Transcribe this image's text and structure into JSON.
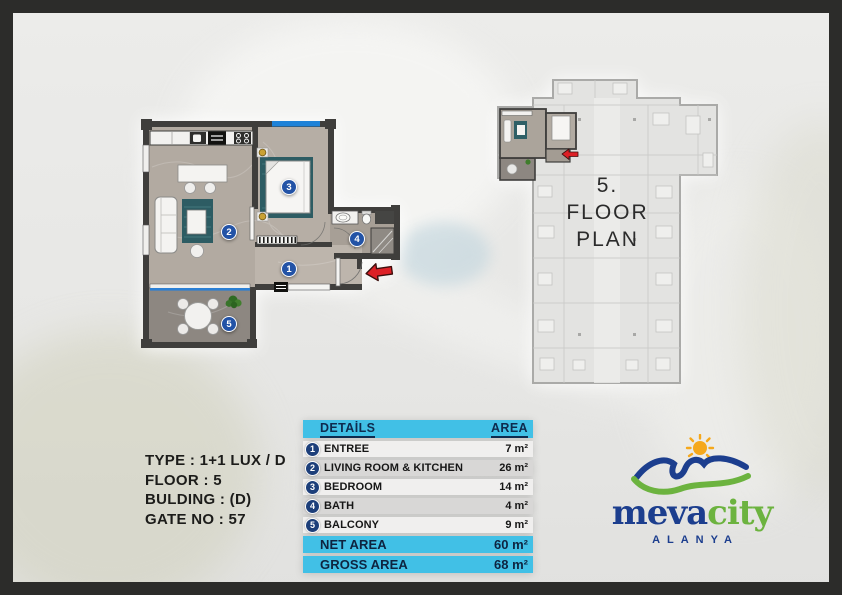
{
  "info": {
    "lines": [
      "TYPE : 1+1 LUX / D",
      "FLOOR : 5",
      "BULDING : (D)",
      "GATE NO : 57"
    ]
  },
  "floor_plan": {
    "line1": "5.",
    "line2": "FLOOR",
    "line3": "PLAN"
  },
  "table": {
    "header": {
      "details": "DETAİLS",
      "area": "AREA"
    },
    "rows": [
      {
        "num": "1",
        "label": "ENTREE",
        "area": "7 m²"
      },
      {
        "num": "2",
        "label": "LIVING ROOM & KITCHEN",
        "area": "26 m²"
      },
      {
        "num": "3",
        "label": "BEDROOM",
        "area": "14 m²"
      },
      {
        "num": "4",
        "label": "BATH",
        "area": "4 m²"
      },
      {
        "num": "5",
        "label": "BALCONY",
        "area": "9 m²"
      }
    ],
    "totals": [
      {
        "label": "NET AREA",
        "area": "60 m²"
      },
      {
        "label": "GROSS AREA",
        "area": "68 m²"
      }
    ]
  },
  "logo": {
    "brand_part1": "meva",
    "brand_part2": "city",
    "city": "ALANYA"
  },
  "colors": {
    "accent_cyan": "#41c0e6",
    "table_badge_navy": "#1d3f7a",
    "plan_marker_blue": "#2353a6",
    "arrow_red": "#dd2026",
    "logo_navy": "#1c3e8e",
    "logo_green": "#6cb33f",
    "logo_orange": "#f5a81c",
    "frame_dark": "#2c2c2a",
    "window_blue": "#1e82d8",
    "rug_teal": "#2d5c63"
  }
}
